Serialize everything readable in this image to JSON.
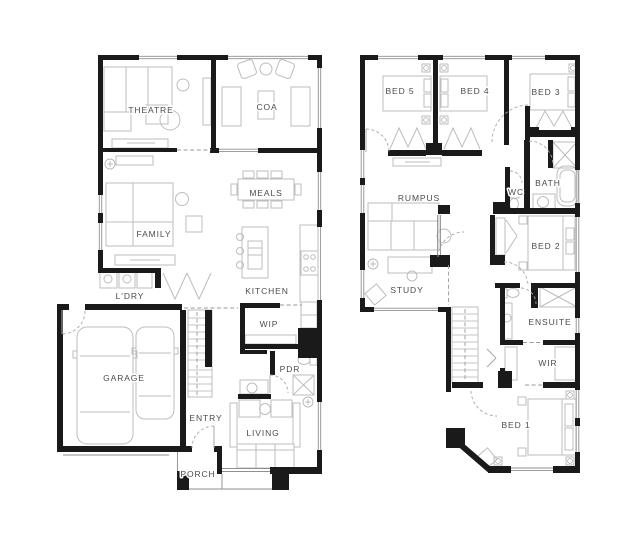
{
  "colors": {
    "background": "#ffffff",
    "wall": "#1a1a1a",
    "furniture_line": "#bdbdbd",
    "door_arc": "#a8a8a8",
    "label_text": "#4c4c4c"
  },
  "plans": {
    "ground": {
      "rooms": {
        "theatre": "THEATRE",
        "coa": "COA",
        "meals": "MEALS",
        "family": "FAMILY",
        "kitchen": "KITCHEN",
        "laundry": "L'DRY",
        "wip": "WIP",
        "garage": "GARAGE",
        "powder": "PDR",
        "entry": "ENTRY",
        "living": "LIVING",
        "porch": "PORCH"
      }
    },
    "first": {
      "rooms": {
        "bed5": "BED 5",
        "bed4": "BED 4",
        "bed3": "BED 3",
        "rumpus": "RUMPUS",
        "wc": "WC",
        "bath": "BATH",
        "bed2": "BED 2",
        "study": "STUDY",
        "ensuite": "ENSUITE",
        "wir": "WIR",
        "bed1": "BED 1"
      }
    }
  }
}
